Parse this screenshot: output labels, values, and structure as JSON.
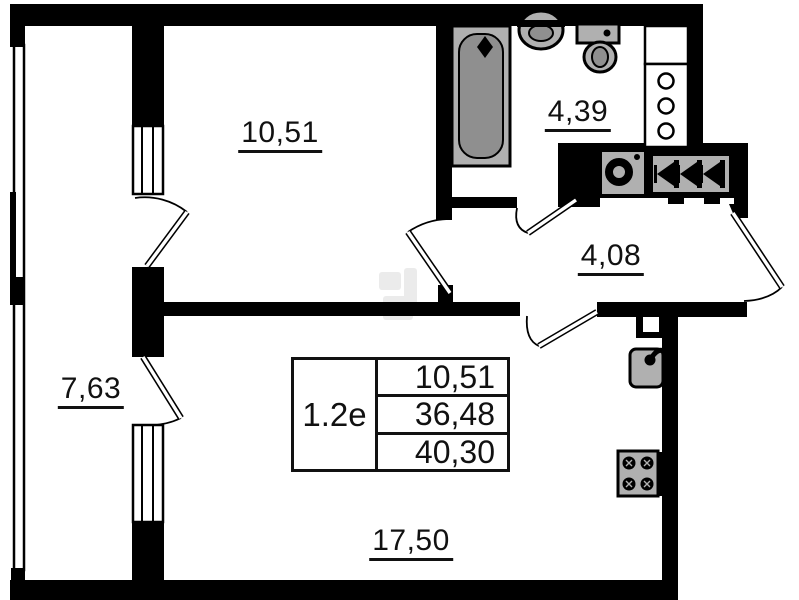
{
  "labels": {
    "room": "10,51",
    "bathroom": "4,39",
    "hallway": "4,08",
    "balcony": "7,63",
    "kitchen_living": "17,50"
  },
  "info_table": {
    "unit_type": "1.2е",
    "rows": [
      "10,51",
      "36,48",
      "40,30"
    ]
  },
  "fixtures": {
    "bathtub": "bathtub-icon",
    "bath_sink": "sink-icon",
    "toilet": "toilet-icon",
    "washing_machine": "washing-machine-icon",
    "ventilation": "ventilation-shaft-icon",
    "utility_shaft": "utility-shaft-icon",
    "kitchen_sink": "kitchen-sink-icon",
    "stove": "stove-icon"
  },
  "colors": {
    "wall": "#000000",
    "ink": "#111111",
    "background": "#ffffff",
    "fixture_fill": "#b0b0b0",
    "fixture_shade": "#8f8f8f",
    "watermark": "#d8d8d8"
  }
}
